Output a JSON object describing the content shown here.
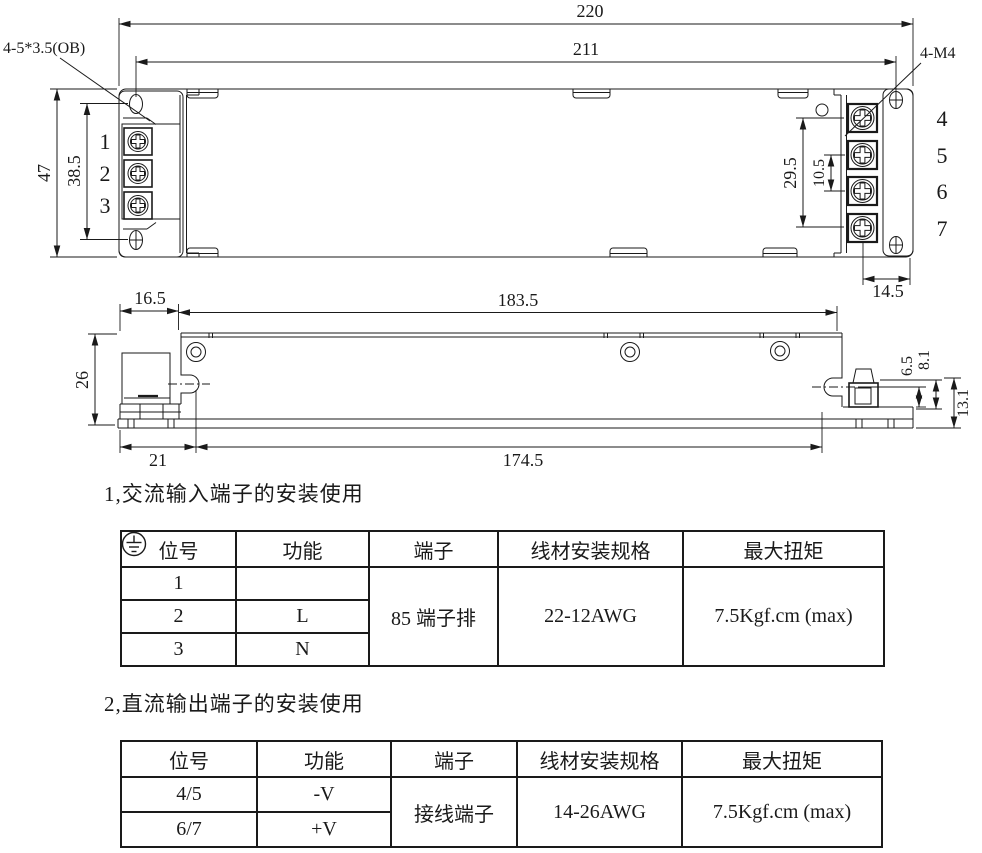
{
  "drawing": {
    "top_view": {
      "dim_overall_width": "220",
      "dim_inner_width": "211",
      "dim_overall_height": "47",
      "dim_mount_hole_span": "38.5",
      "label_input_holes": "4-5*3.5(OB)",
      "label_output_screws": "4-M4",
      "dim_output_span": "29.5",
      "dim_output_pitch": "10.5",
      "dim_output_edge": "14.5",
      "input_terminals": [
        "1",
        "2",
        "3"
      ],
      "output_terminals": [
        "4",
        "5",
        "6",
        "7"
      ]
    },
    "side_view": {
      "dim_left_offset": "16.5",
      "dim_body_length": "183.5",
      "dim_height": "26",
      "dim_bottom_left": "21",
      "dim_bottom_length": "174.5",
      "dim_right_small": "6.5",
      "dim_right_mid": "8.1",
      "dim_right_total": "13.1"
    },
    "line_color": "#1a1a1a"
  },
  "section1": {
    "heading": "1,交流输入端子的安装使用",
    "table": {
      "headers": [
        "位号",
        "功能",
        "端子",
        "线材安装规格",
        "最大扭矩"
      ],
      "rows": [
        {
          "pos": "1",
          "func_icon": "earth-ground"
        },
        {
          "pos": "2",
          "func": "L"
        },
        {
          "pos": "3",
          "func": "N"
        }
      ],
      "terminal": "85 端子排",
      "wire_spec": "22-12AWG",
      "max_torque": "7.5Kgf.cm (max)"
    }
  },
  "section2": {
    "heading": "2,直流输出端子的安装使用",
    "table": {
      "headers": [
        "位号",
        "功能",
        "端子",
        "线材安装规格",
        "最大扭矩"
      ],
      "rows": [
        {
          "pos": "4/5",
          "func": "-V"
        },
        {
          "pos": "6/7",
          "func": "+V"
        }
      ],
      "terminal": "接线端子",
      "wire_spec": "14-26AWG",
      "max_torque": "7.5Kgf.cm (max)"
    }
  }
}
